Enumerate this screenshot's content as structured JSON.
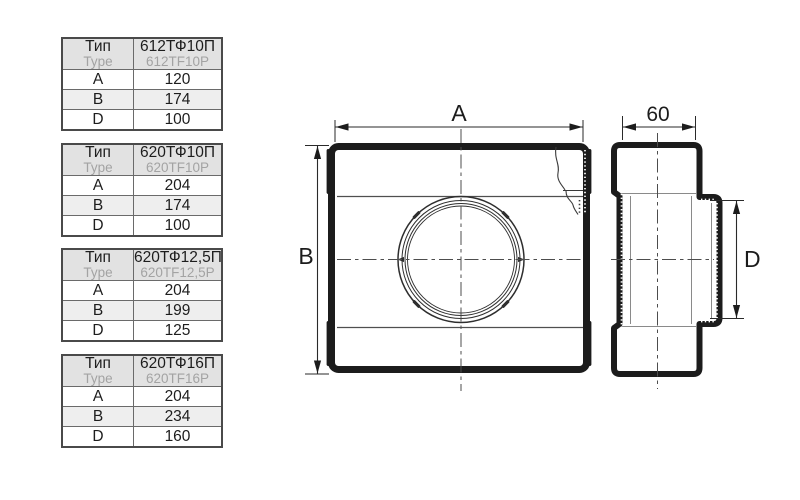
{
  "tables": [
    {
      "type_label_ru": "Тип",
      "type_label_en": "Type",
      "model_ru": "612ТФ10П",
      "model_en": "612TF10P",
      "rows": [
        {
          "param": "A",
          "value": "120"
        },
        {
          "param": "B",
          "value": "174"
        },
        {
          "param": "D",
          "value": "100"
        }
      ]
    },
    {
      "type_label_ru": "Тип",
      "type_label_en": "Type",
      "model_ru": "620ТФ10П",
      "model_en": "620TF10P",
      "rows": [
        {
          "param": "A",
          "value": "204"
        },
        {
          "param": "B",
          "value": "174"
        },
        {
          "param": "D",
          "value": "100"
        }
      ]
    },
    {
      "type_label_ru": "Тип",
      "type_label_en": "Type",
      "model_ru": "620ТФ12,5П",
      "model_en": "620TF12,5P",
      "rows": [
        {
          "param": "A",
          "value": "204"
        },
        {
          "param": "B",
          "value": "199"
        },
        {
          "param": "D",
          "value": "125"
        }
      ]
    },
    {
      "type_label_ru": "Тип",
      "type_label_en": "Type",
      "model_ru": "620ТФ16П",
      "model_en": "620TF16P",
      "rows": [
        {
          "param": "A",
          "value": "204"
        },
        {
          "param": "B",
          "value": "234"
        },
        {
          "param": "D",
          "value": "160"
        }
      ]
    }
  ],
  "drawing": {
    "front_view": {
      "width_label": "A",
      "height_label": "B"
    },
    "side_view": {
      "depth_label": "60",
      "diameter_label": "D"
    }
  },
  "colors": {
    "outline": "#1c1c1c",
    "thin_line": "#3a3a3a",
    "inner_line": "#8a8a8a",
    "centerline": "#4d4d4d",
    "table_border": "#4a4a4a",
    "header_bg": "#e2e2e2",
    "alt_row_bg": "#eeeeee",
    "secondary_text": "#a3a3a3"
  }
}
